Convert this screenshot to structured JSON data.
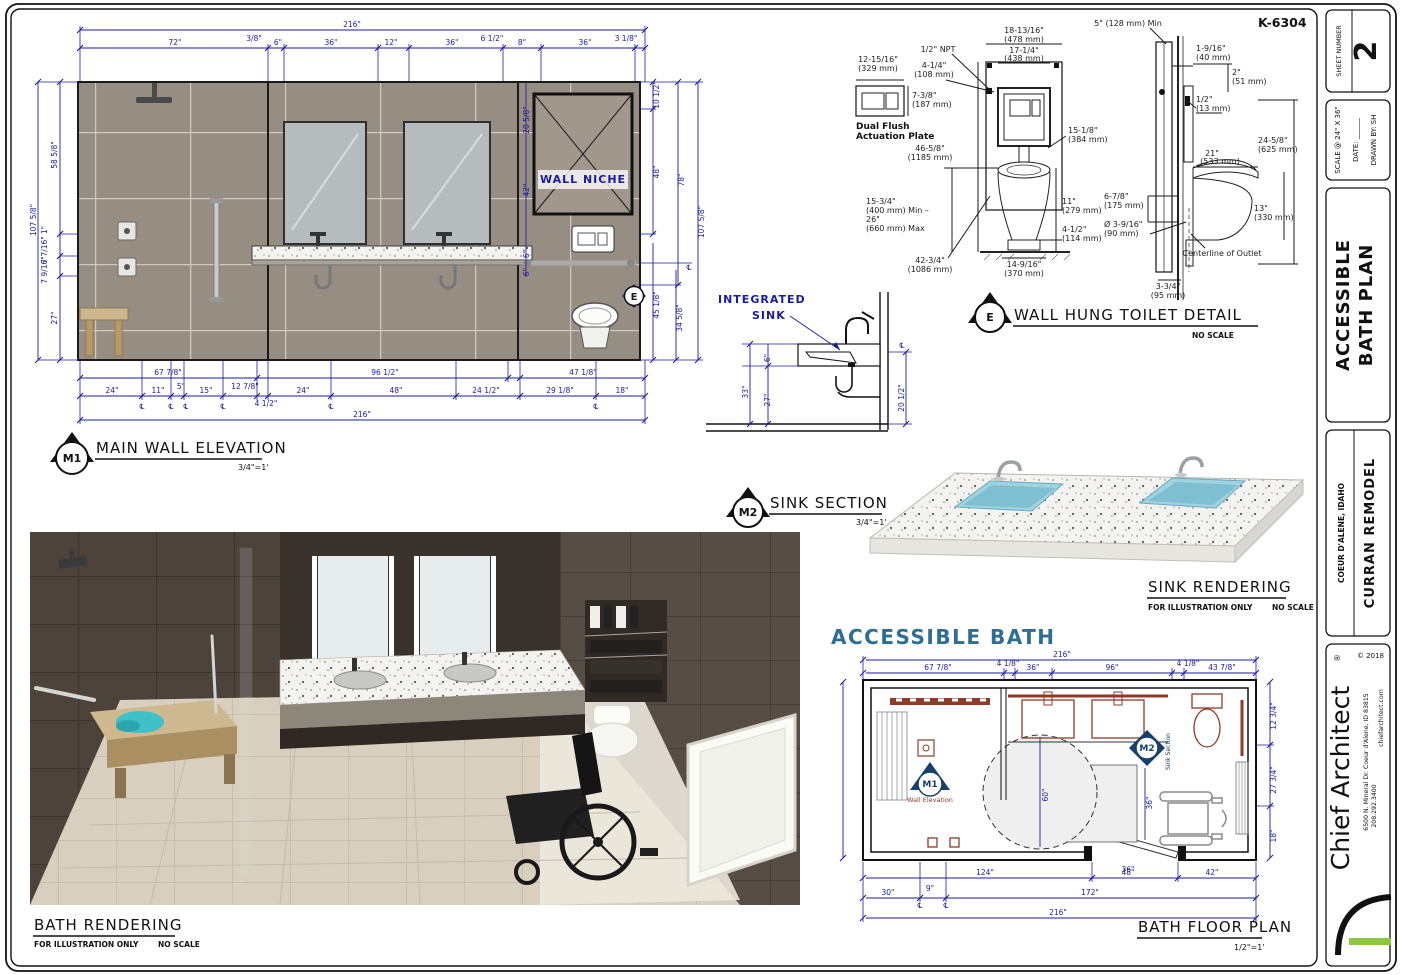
{
  "title_block": {
    "sheet_number_label": "SHEET NUMBER",
    "sheet_number": "2",
    "scale_at": "SCALE @ 24\" X 36\"",
    "date_label": "DATE: ______",
    "drawn_by": "DRAWN BY: SH",
    "plan_title_line1": "ACCESSIBLE",
    "plan_title_line2": "BATH PLAN",
    "location": "COEUR D'ALENE, IDAHO",
    "project": "CURRAN REMODEL",
    "copyright": "© 2018",
    "brand": "Chief Architect",
    "reg": "®",
    "address": "6500 N. Mineral Dr.  Coeur d'Alene, ID 83815",
    "phone": "208.292.3400",
    "website": "chiefarchitect.com"
  },
  "colors": {
    "dim_blue": "#1b1b9e",
    "heading_blue": "#2e6d96",
    "fixture_red": "#8e3b28",
    "marker_navy": "#17406b",
    "accent_green": "#8dc63f",
    "tile_wall": "#968d83",
    "sink_blue": "#9fd3e2"
  },
  "elevation": {
    "marker": "M1",
    "title": "MAIN WALL ELEVATION",
    "scale": "3/4\"=1'",
    "wall_niche": "WALL NICHE",
    "dims_top": [
      "216\"",
      "72\"",
      "3/8\"",
      "6\"",
      "36\"",
      "12\"",
      "36\"",
      "6 1/2\"",
      "8\"",
      "36\"",
      "3 1/8\""
    ],
    "dims_left": [
      "107 5/8\"",
      "58 5/8\"",
      "1\"",
      "7 7/16\"",
      "7 9/16\"",
      "27\""
    ],
    "dims_right": [
      "10 1/2\"",
      "20 5/8\"",
      "42\"",
      "48\"",
      "78\"",
      "107 5/8\"",
      "6\"",
      "6\"",
      "℄",
      "45 1/8\"",
      "34 5/8\""
    ],
    "dims_bottom": [
      "67 7/8\"",
      "96 1/2\"",
      "47 1/8\"",
      "24\"",
      "11\"",
      "5\"",
      "15\"",
      "12 7/8\"",
      "4 1/2\"",
      "24\"",
      "48\"",
      "24 1/2\"",
      "29 1/8\"",
      "18\"",
      "216\"",
      "℄"
    ]
  },
  "toilet_detail": {
    "marker": "E",
    "title": "WALL HUNG TOILET DETAIL",
    "scale": "NO SCALE",
    "model": "K-6304",
    "plate_label1": "Dual Flush",
    "plate_label2": "Actuation Plate",
    "centerline_label": "Centerline of Outlet",
    "dims": [
      [
        "1/2\" NPT"
      ],
      [
        "4-1/4\"",
        "(108 mm)"
      ],
      [
        "12-15/16\"",
        "(329 mm)"
      ],
      [
        "7-3/8\"",
        "(187 mm)"
      ],
      [
        "18-13/16\"",
        "(478 mm)"
      ],
      [
        "17-1/4\"",
        "(438 mm)"
      ],
      [
        "46-5/8\"",
        "(1185 mm)"
      ],
      [
        "15-1/8\"",
        "(384 mm)"
      ],
      [
        "15-3/4\"",
        "(400 mm) Min –",
        "26\"",
        "(660 mm) Max"
      ],
      [
        "42-3/4\"",
        "(1086 mm)"
      ],
      [
        "14-9/16\"",
        "(370 mm)"
      ],
      [
        "11\"",
        "(279 mm)"
      ],
      [
        "4-1/2\"",
        "(114 mm)"
      ],
      [
        "5\" (128 mm) Min"
      ],
      [
        "1-9/16\"",
        "(40 mm)"
      ],
      [
        "2\"",
        "(51 mm)"
      ],
      [
        "1/2\"",
        "(13 mm)"
      ],
      [
        "24-5/8\"",
        "(625 mm)"
      ],
      [
        "21\"",
        "(533 mm)"
      ],
      [
        "6-7/8\"",
        "(175 mm)"
      ],
      [
        "Ø 3-9/16\"",
        "(90 mm)"
      ],
      [
        "13\"",
        "(330 mm)"
      ],
      [
        "3-3/4\"",
        "(95 mm)"
      ]
    ]
  },
  "sink_section": {
    "marker": "M2",
    "title": "SINK SECTION",
    "scale": "3/4\"=1'",
    "label_line1": "INTEGRATED",
    "label_line2": "SINK",
    "dims": [
      "6\"",
      "33\"",
      "27\"",
      "20 1/2\"",
      "℄"
    ]
  },
  "sink_rendering": {
    "title": "SINK RENDERING",
    "note": "FOR ILLUSTRATION ONLY",
    "scale": "NO SCALE"
  },
  "bath_rendering": {
    "title": "BATH RENDERING",
    "note": "FOR ILLUSTRATION ONLY",
    "scale": "NO SCALE"
  },
  "floor_plan": {
    "heading": "ACCESSIBLE BATH",
    "title": "BATH FLOOR PLAN",
    "scale": "1/2\"=1'",
    "marker_m1": "M1",
    "marker_m1_label": "Wall Elevation",
    "marker_m2": "M2",
    "marker_m2_label": "Sink Section",
    "dims_top": [
      "216\"",
      "67 7/8\"",
      "4 1/8\"",
      "36\"",
      "96\"",
      "4 1/8\"",
      "43 7/8\""
    ],
    "dims_right": [
      "12 3/4\"",
      "27 3/4\"",
      "18\""
    ],
    "dims_bottom": [
      "124\"",
      "48\"",
      "42\"",
      "30\"",
      "9\"",
      "172\"",
      "216\"",
      "36\"",
      "℄"
    ],
    "dims_interior": [
      "60\"",
      "36\""
    ]
  }
}
